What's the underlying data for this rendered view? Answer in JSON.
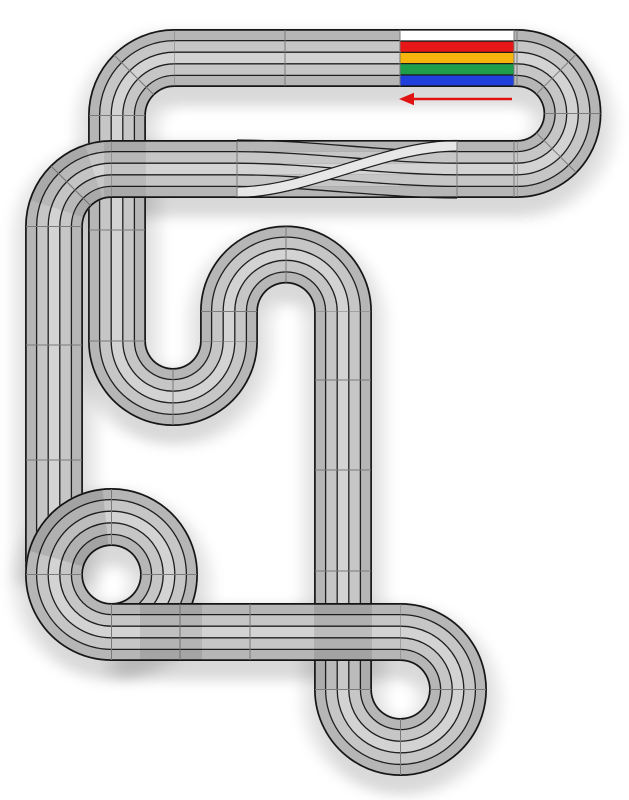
{
  "canvas": {
    "width": 629,
    "height": 800,
    "background": "#ffffff"
  },
  "track": {
    "lane_count": 5,
    "band_width": 58,
    "lane_width": 11.6,
    "style": {
      "surface": "#c6c6c6",
      "lane_shades": [
        "#b6b6b6",
        "#c6c6c6",
        "#d3d3d3",
        "#c6c6c6",
        "#b6b6b6"
      ],
      "edge": "#161616",
      "lane_line": "#1f1f1f",
      "joint": "#7a7a7a",
      "shadow_opacity": 0.08,
      "overlap_tint": "#000000"
    },
    "segments": [
      {
        "name": "left-outer-vertical",
        "type": "line",
        "x1": 54,
        "y1": 226.5,
        "x2": 54,
        "y2": 574.5
      },
      {
        "name": "spiral-circle",
        "type": "circle",
        "cx": 111.5,
        "cy": 574.5,
        "r": 57.5
      },
      {
        "name": "left-inner-vertical",
        "type": "line",
        "x1": 117,
        "y1": 115.5,
        "x2": 117,
        "y2": 341
      },
      {
        "name": "row2-west-corner",
        "type": "arc",
        "cx": 111.5,
        "cy": 226.5,
        "r": 57.5,
        "a0": 180,
        "a1": 270
      },
      {
        "name": "top-left-corner",
        "type": "arc",
        "cx": 174.5,
        "cy": 115.5,
        "r": 57.5,
        "a0": 180,
        "a1": 270
      },
      {
        "name": "top-straight",
        "type": "line",
        "x1": 174.5,
        "y1": 58,
        "x2": 517,
        "y2": 58
      },
      {
        "name": "top-right-180",
        "type": "arc",
        "cx": 517,
        "cy": 113.5,
        "r": 55.5,
        "a0": 270,
        "a1": 450
      },
      {
        "name": "crossover-straight",
        "type": "line",
        "x1": 517,
        "y1": 169,
        "x2": 111.5,
        "y2": 169
      },
      {
        "name": "u-dip-180",
        "type": "arc",
        "cx": 173,
        "cy": 341,
        "r": 56,
        "a0": 0,
        "a1": 180
      },
      {
        "name": "n-left-leg",
        "type": "line",
        "x1": 229,
        "y1": 311.5,
        "x2": 229,
        "y2": 341
      },
      {
        "name": "n-180",
        "type": "arc",
        "cx": 286,
        "cy": 311.5,
        "r": 57,
        "a0": 180,
        "a1": 360
      },
      {
        "name": "n-right-leg",
        "type": "line",
        "x1": 343,
        "y1": 311.5,
        "x2": 343,
        "y2": 689.5
      },
      {
        "name": "bottom-right-loop",
        "type": "arc",
        "cx": 400.5,
        "cy": 689.5,
        "r": 57.5,
        "a0": 180,
        "a1": -90
      },
      {
        "name": "bottom-straight",
        "type": "line",
        "x1": 400.5,
        "y1": 632,
        "x2": 111.5,
        "y2": 632
      }
    ],
    "joints": [
      {
        "seg": "top-straight",
        "kind": "tick",
        "at": 285
      },
      {
        "seg": "top-straight",
        "kind": "tick",
        "at": 400
      },
      {
        "seg": "top-straight",
        "kind": "tick",
        "at": 514
      },
      {
        "seg": "crossover-straight",
        "kind": "tick",
        "at": 237
      },
      {
        "seg": "crossover-straight",
        "kind": "tick",
        "at": 457
      },
      {
        "seg": "crossover-straight",
        "kind": "tick",
        "at": 514
      },
      {
        "seg": "left-outer-vertical",
        "kind": "tick",
        "at": 345
      },
      {
        "seg": "left-outer-vertical",
        "kind": "tick",
        "at": 460
      },
      {
        "seg": "left-inner-vertical",
        "kind": "tick",
        "at": 230
      },
      {
        "seg": "n-right-leg",
        "kind": "tick",
        "at": 380
      },
      {
        "seg": "n-right-leg",
        "kind": "tick",
        "at": 470
      },
      {
        "seg": "n-right-leg",
        "kind": "tick",
        "at": 571
      },
      {
        "seg": "bottom-straight",
        "kind": "tick",
        "at": 180
      },
      {
        "seg": "bottom-straight",
        "kind": "tick",
        "at": 250
      },
      {
        "seg": "spiral-circle",
        "kind": "radial",
        "angle": 0
      },
      {
        "seg": "spiral-circle",
        "kind": "radial",
        "angle": 90
      },
      {
        "seg": "spiral-circle",
        "kind": "radial",
        "angle": 180
      },
      {
        "seg": "spiral-circle",
        "kind": "radial",
        "angle": 270
      },
      {
        "seg": "top-right-180",
        "kind": "radial",
        "angle": 315
      },
      {
        "seg": "top-right-180",
        "kind": "radial",
        "angle": 360
      },
      {
        "seg": "top-right-180",
        "kind": "radial",
        "angle": 405
      },
      {
        "seg": "n-180",
        "kind": "radial",
        "angle": 270
      },
      {
        "seg": "u-dip-180",
        "kind": "radial",
        "angle": 90
      },
      {
        "seg": "top-left-corner",
        "kind": "radial",
        "angle": 225
      },
      {
        "seg": "row2-west-corner",
        "kind": "radial",
        "angle": 225
      },
      {
        "seg": "bottom-right-loop",
        "kind": "radial",
        "angle": 0
      },
      {
        "seg": "bottom-right-loop",
        "kind": "radial",
        "angle": 90
      }
    ],
    "overlap_tints": [
      {
        "type": "arcband",
        "seg": "spiral-circle",
        "a0": 196,
        "a1": 264,
        "opacity": 0.1
      },
      {
        "type": "arcband",
        "seg": "row2-west-corner",
        "a0": 198,
        "a1": 252,
        "opacity": 0.07
      },
      {
        "type": "rect",
        "x": 104,
        "y": 141,
        "w": 42,
        "h": 56,
        "opacity": 0.07
      },
      {
        "type": "rect",
        "x": 140,
        "y": 603,
        "w": 62,
        "h": 58,
        "opacity": 0.09
      },
      {
        "type": "rect",
        "x": 314,
        "y": 603,
        "w": 58,
        "h": 58,
        "opacity": 0.1
      },
      {
        "type": "rect",
        "x": 314,
        "y": 661,
        "w": 58,
        "h": 28,
        "opacity": 0.05
      }
    ]
  },
  "crossover": {
    "x1": 237,
    "x2": 457,
    "band_top": 140,
    "lane_shift": 1,
    "light_band_color": "#e7e7e7",
    "light_band_from_y": 192.2,
    "light_band_to_y": 145.8
  },
  "start_finish": {
    "x": 400,
    "width": 114,
    "band_top": 29.8,
    "band_bottom": 86.2,
    "lane_colors": [
      "#ffffff",
      "#e81717",
      "#f6b40d",
      "#1e9e4b",
      "#2040dd"
    ]
  },
  "direction_arrow": {
    "color": "#e01212",
    "y": 99,
    "x_tail": 512,
    "x_head": 399,
    "line_width": 2.6,
    "meaning": "race direction westward"
  }
}
